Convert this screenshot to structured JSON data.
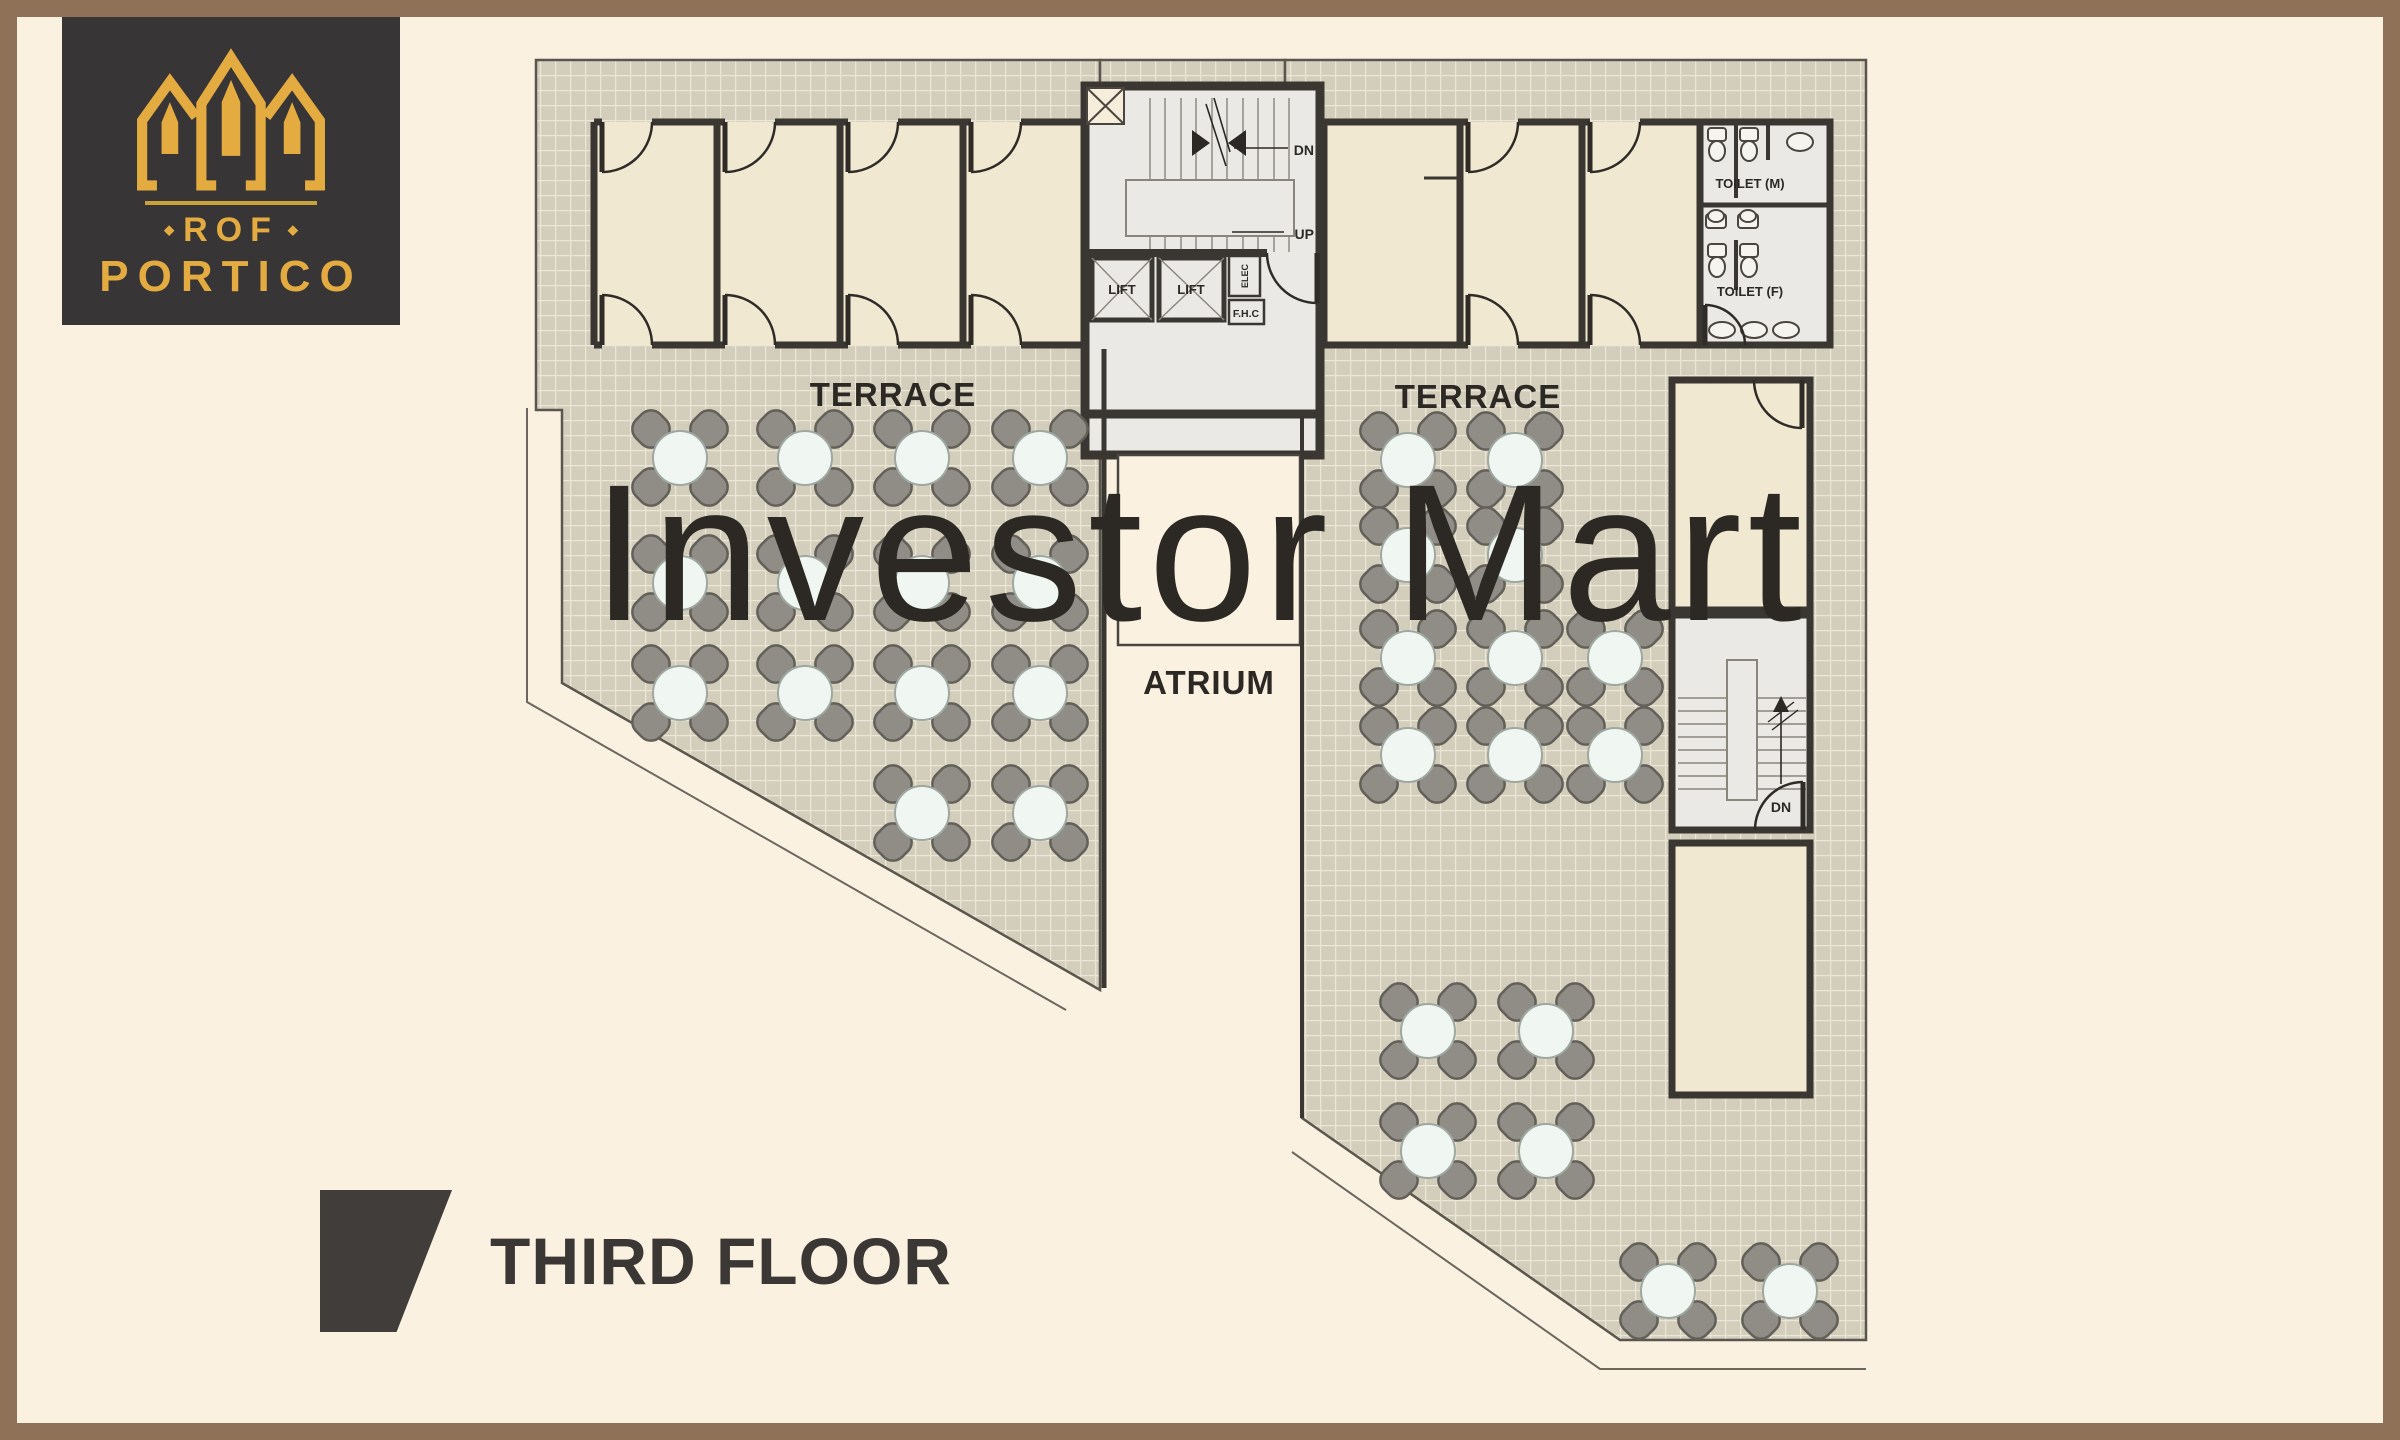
{
  "logo": {
    "brand": "ROF",
    "project": "PORTICO",
    "dot": "◆",
    "bg_color": "#383536",
    "gold_color": "#E3AB40"
  },
  "floor_title": "THIRD FLOOR",
  "watermark": "Investor Mart",
  "plan": {
    "labels": {
      "terrace_left": "TERRACE",
      "terrace_right": "TERRACE",
      "atrium": "ATRIUM",
      "core_dn": "DN",
      "core_up": "UP",
      "lift1": "LIFT",
      "lift2": "LIFT",
      "elec": "ELEC",
      "fhc": "F.H.C",
      "toilet_m": "TOILET (M)",
      "toilet_f": "TOILET (F)",
      "stair_right_dn": "DN"
    },
    "colors": {
      "frame_brown": "#8E7156",
      "background_cream": "#FAF1E1",
      "floor_grid": "#D3CDBB",
      "grid_line": "#EBE6D6",
      "wall_dark": "#3A3631",
      "room_beige": "#F1E8D1",
      "core_floor": "#EAE9E5",
      "chair_gray": "#8F8D86",
      "table_white": "#F0F7F2",
      "title_dark": "#3B3734"
    },
    "tables": {
      "left_terrace": [
        [
          680,
          458
        ],
        [
          805,
          458
        ],
        [
          922,
          458
        ],
        [
          1040,
          458
        ],
        [
          680,
          583
        ],
        [
          805,
          583
        ],
        [
          922,
          583
        ],
        [
          1040,
          583
        ],
        [
          680,
          693
        ],
        [
          805,
          693
        ],
        [
          922,
          693
        ],
        [
          1040,
          693
        ],
        [
          922,
          813
        ],
        [
          1040,
          813
        ]
      ],
      "right_terrace_upper": [
        [
          1408,
          460
        ],
        [
          1515,
          460
        ],
        [
          1408,
          555
        ],
        [
          1515,
          555
        ],
        [
          1408,
          658
        ],
        [
          1515,
          658
        ],
        [
          1615,
          658
        ],
        [
          1408,
          755
        ],
        [
          1515,
          755
        ],
        [
          1615,
          755
        ]
      ],
      "right_terrace_lower": [
        [
          1428,
          1031
        ],
        [
          1546,
          1031
        ],
        [
          1428,
          1151
        ],
        [
          1546,
          1151
        ]
      ],
      "bottom_right": [
        [
          1668,
          1291
        ],
        [
          1790,
          1291
        ]
      ]
    }
  }
}
